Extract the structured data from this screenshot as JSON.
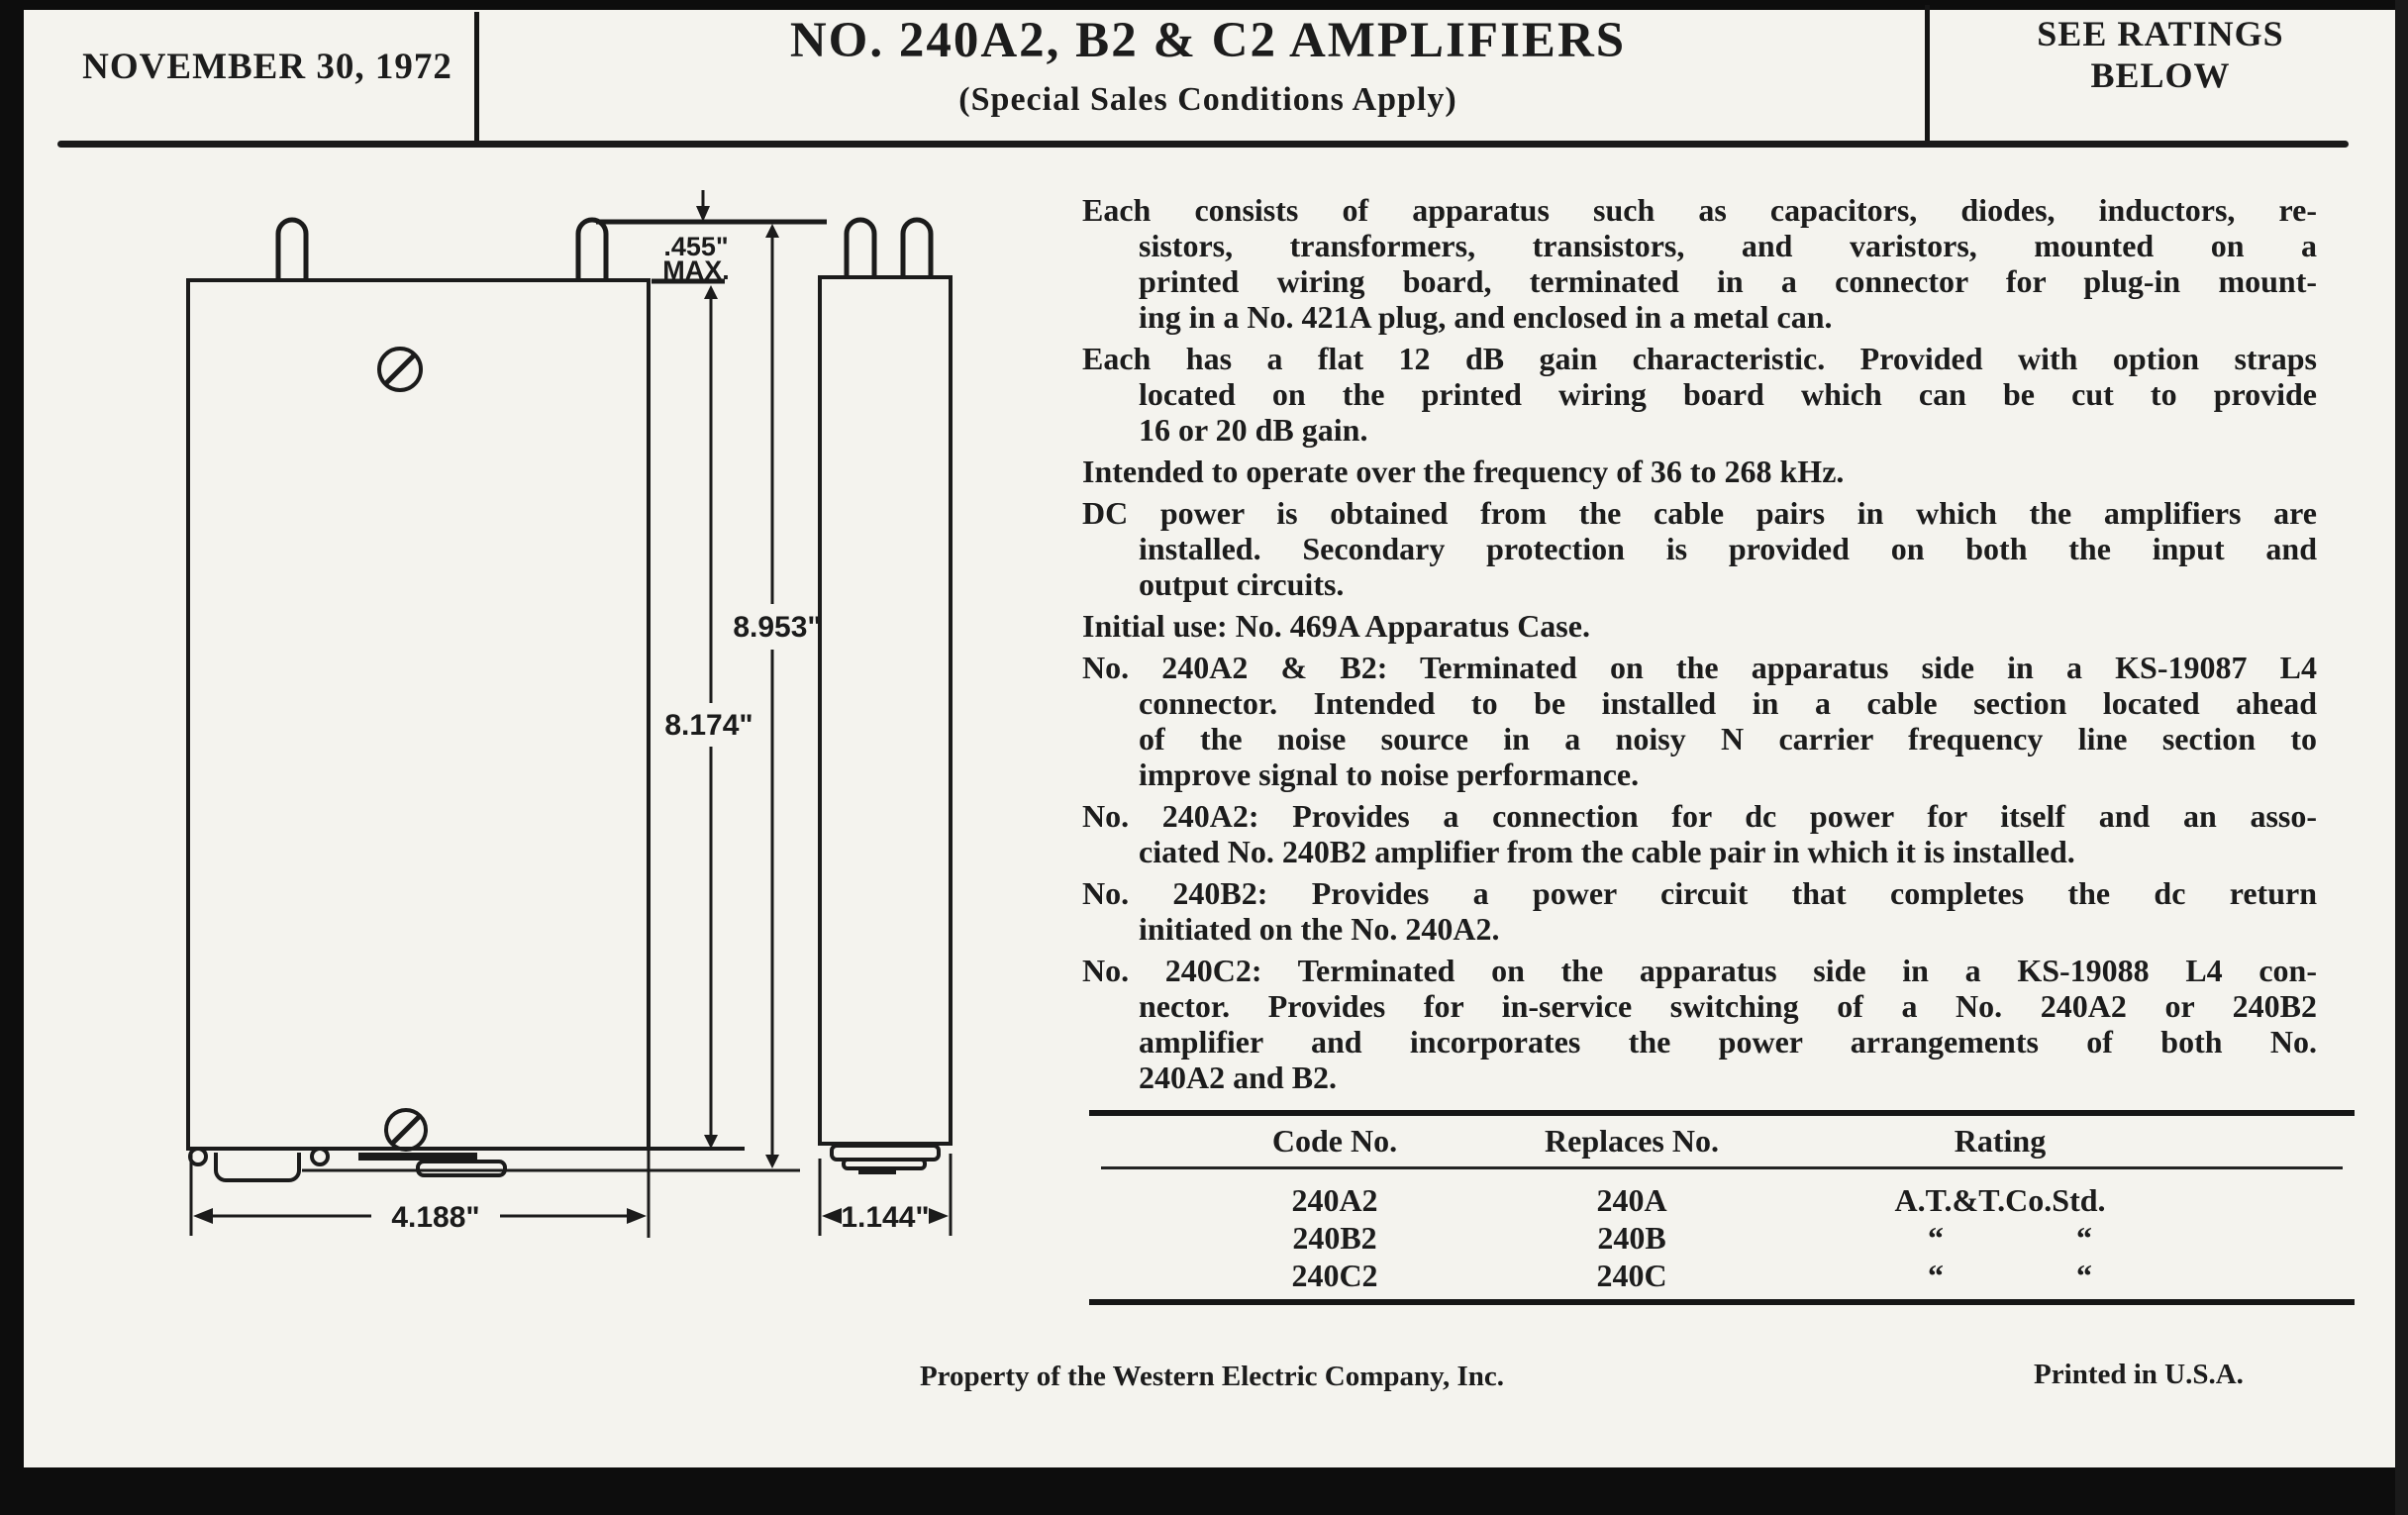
{
  "page": {
    "header": {
      "date": "NOVEMBER 30, 1972",
      "title": "NO. 240A2, B2 & C2 AMPLIFIERS",
      "subtitle": "(Special Sales Conditions Apply)",
      "ratings_note_line1": "SEE RATINGS",
      "ratings_note_line2": "BELOW"
    },
    "drawing": {
      "dims": {
        "pin_height": ".455\"",
        "pin_height_qualifier": "MAX.",
        "overall_height": "8.953\"",
        "can_height": "8.174\"",
        "front_width": "4.188\"",
        "side_width": "1.144\""
      }
    },
    "paragraphs": [
      {
        "lines": [
          "Each consists of apparatus such as capacitors, diodes, inductors, re-",
          "sistors, transformers, transistors, and varistors, mounted on a",
          "printed wiring board, terminated in a connector for plug-in mount-",
          "ing in a No. 421A plug, and enclosed in a metal can."
        ]
      },
      {
        "lines": [
          "Each has a flat 12 dB gain characteristic.  Provided with option straps",
          "located on the printed wiring board which can be cut to provide",
          "16 or 20 dB gain."
        ]
      },
      {
        "lines": [
          "Intended to operate over the frequency of 36 to 268 kHz."
        ]
      },
      {
        "lines": [
          "DC power is obtained from the cable pairs in which the amplifiers are",
          "installed.  Secondary protection is provided on both the input and",
          "output circuits."
        ]
      },
      {
        "lines": [
          "Initial use:  No. 469A Apparatus Case."
        ]
      },
      {
        "lines": [
          "No. 240A2 & B2:  Terminated on the apparatus side in a KS-19087 L4",
          "connector.  Intended to be installed in a cable section located ahead",
          "of the noise source in a noisy N carrier frequency line section to",
          "improve signal to noise performance."
        ]
      },
      {
        "lines": [
          "No. 240A2:  Provides a connection for dc power for itself and an asso-",
          "ciated No. 240B2 amplifier from the cable pair in which it is installed."
        ]
      },
      {
        "lines": [
          "No. 240B2:  Provides a power circuit that completes the dc return",
          "initiated on the No. 240A2."
        ]
      },
      {
        "lines": [
          "No. 240C2:  Terminated on the apparatus side in a KS-19088 L4 con-",
          "nector.  Provides for in-service switching of a No. 240A2 or 240B2",
          "amplifier and incorporates the power arrangements of both No.",
          "240A2 and B2."
        ]
      }
    ],
    "table": {
      "columns": [
        "Code No.",
        "Replaces No.",
        "Rating"
      ],
      "ditto_mark": "“",
      "rows": [
        {
          "code": "240A2",
          "replaces": "240A",
          "rating": "A.T.&T.Co.Std.",
          "ditto": false
        },
        {
          "code": "240B2",
          "replaces": "240B",
          "rating": "",
          "ditto": true
        },
        {
          "code": "240C2",
          "replaces": "240C",
          "rating": "",
          "ditto": true
        }
      ]
    },
    "footer": {
      "property": "Property of the Western Electric Company, Inc.",
      "printed": "Printed in U.S.A."
    }
  }
}
